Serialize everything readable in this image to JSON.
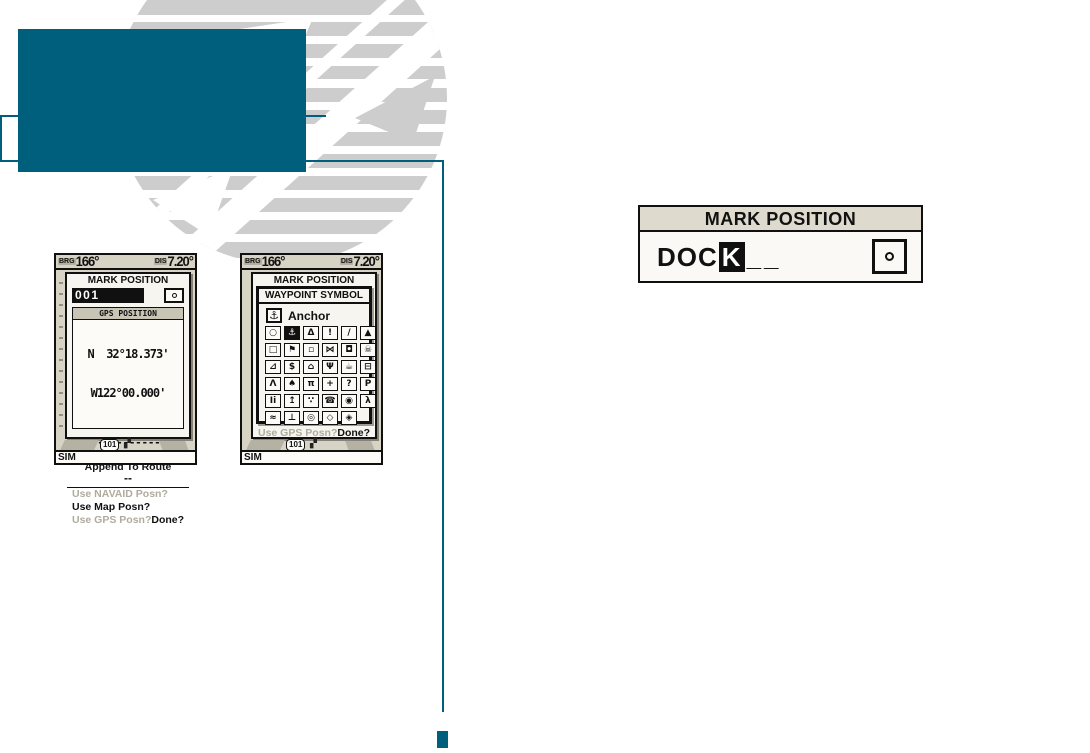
{
  "accent_color": "#005F7D",
  "watermark_color": "#CDCDCD",
  "status_bar": {
    "brg_label": "BRG",
    "brg_value": "166°",
    "dis_label": "DIS",
    "dis_value": "7.20°"
  },
  "mark_popup": {
    "title": "MARK POSITION",
    "name_value": "001",
    "symbol_icon": "circle-dot-icon",
    "gps_header": "GPS POSITION",
    "lat": "N  32°18.373'",
    "lon": "W122°00.000'",
    "comment_line1": "--------------",
    "comment_line2": "----",
    "append_label": "Append To Route",
    "route_value": "--",
    "opt_navaid": "Use NAVAID Posn?",
    "opt_map": "Use Map Posn?",
    "opt_gps": "Use GPS Posn?",
    "done_label": "Done?"
  },
  "symbol_window": {
    "title": "WAYPOINT SYMBOL",
    "selected_label": "Anchor",
    "selected_glyph": "⚓",
    "symbols": [
      {
        "n": "dot",
        "g": "○"
      },
      {
        "n": "anchor",
        "g": "⚓",
        "sel": true
      },
      {
        "n": "bell",
        "g": "Δ"
      },
      {
        "n": "exclamation",
        "g": "!"
      },
      {
        "n": "slant-exclamation",
        "g": "/"
      },
      {
        "n": "triangle",
        "g": "▲"
      },
      {
        "n": "square",
        "g": "□"
      },
      {
        "n": "flag",
        "g": "⚑"
      },
      {
        "n": "small-square",
        "g": "▫"
      },
      {
        "n": "fish",
        "g": "⋈"
      },
      {
        "n": "fuel",
        "g": "◘"
      },
      {
        "n": "skull",
        "g": "☠"
      },
      {
        "n": "boat-ramp",
        "g": "⊿"
      },
      {
        "n": "dollar",
        "g": "$"
      },
      {
        "n": "house",
        "g": "⌂"
      },
      {
        "n": "restaurant",
        "g": "Ψ"
      },
      {
        "n": "mug",
        "g": "☕"
      },
      {
        "n": "shipwreck",
        "g": "⊟"
      },
      {
        "n": "camp",
        "g": "Λ"
      },
      {
        "n": "tree",
        "g": "♠"
      },
      {
        "n": "picnic",
        "g": "π"
      },
      {
        "n": "first-aid",
        "g": "+"
      },
      {
        "n": "question",
        "g": "?"
      },
      {
        "n": "parking",
        "g": "P"
      },
      {
        "n": "restroom",
        "g": "Ii"
      },
      {
        "n": "fountain",
        "g": "↥"
      },
      {
        "n": "shower",
        "g": "∵"
      },
      {
        "n": "telephone",
        "g": "☎"
      },
      {
        "n": "camera",
        "g": "◉"
      },
      {
        "n": "skier",
        "g": "λ"
      },
      {
        "n": "swim-area",
        "g": "≈"
      },
      {
        "n": "dock",
        "g": "⊥"
      },
      {
        "n": "circle-ring",
        "g": "◎"
      },
      {
        "n": "diamond",
        "g": "◇"
      },
      {
        "n": "diamond-dot",
        "g": "◈"
      }
    ]
  },
  "device_chrome": {
    "map_badge": "101",
    "sim_label": "SIM"
  },
  "callout": {
    "title": "MARK POSITION",
    "typed": "DOC",
    "cursor_char": "K",
    "blanks": "__",
    "symbol_icon": "circle-dot-icon"
  }
}
